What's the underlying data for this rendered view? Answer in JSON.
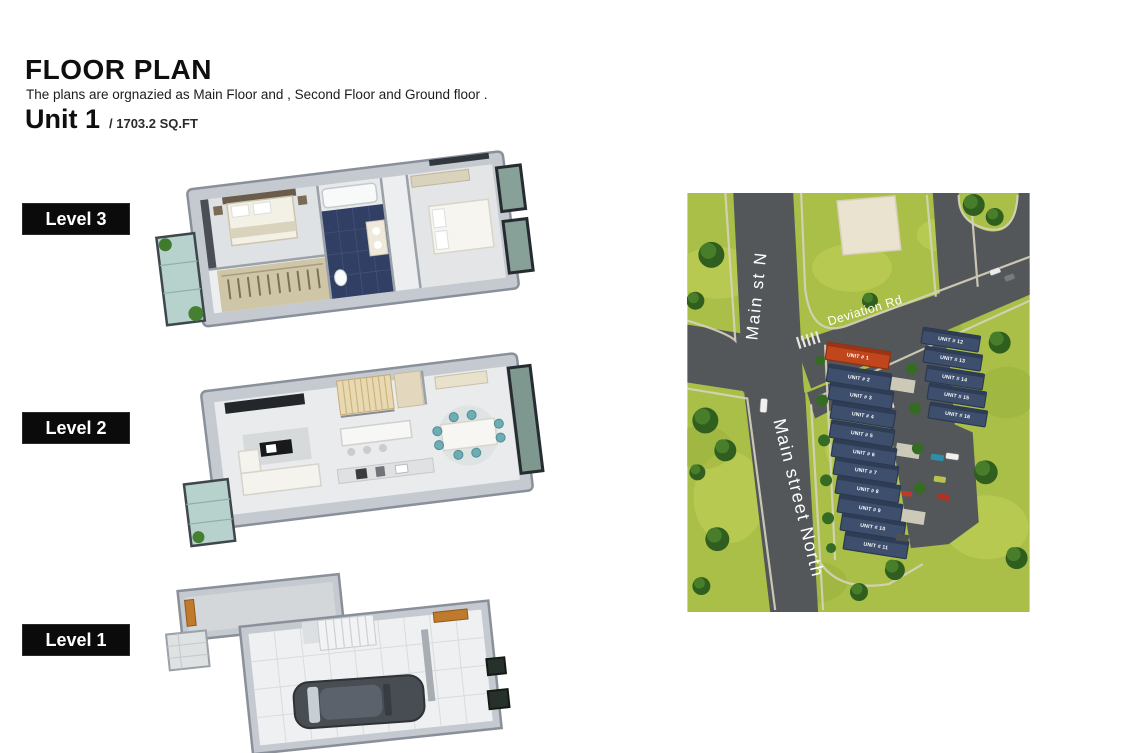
{
  "header": {
    "title": "FLOOR PLAN",
    "subtitle": "The plans are orgnazied as Main Floor and , Second Floor and Ground floor .",
    "unit_name": "Unit 1",
    "unit_area": "/ 1703.2 SQ.FT"
  },
  "levels": [
    {
      "label": "Level 3"
    },
    {
      "label": "Level 2"
    },
    {
      "label": "Level 1"
    }
  ],
  "site_map": {
    "road_labels": {
      "main_st_n": "Main st N",
      "deviation_rd": "Deviation Rd",
      "main_street_north": "Main street North"
    },
    "units": [
      "UNIT # 1",
      "UNIT # 2",
      "UNIT # 3",
      "UNIT # 4",
      "UNIT # 5",
      "UNIT # 6",
      "UNIT # 7",
      "UNIT # 8",
      "UNIT # 9",
      "UNIT # 10",
      "UNIT # 11",
      "UNIT # 12",
      "UNIT # 13",
      "UNIT # 14",
      "UNIT # 15",
      "UNIT # 16"
    ],
    "highlighted_unit": "UNIT # 1",
    "colors": {
      "highlight_unit": "#c0471d",
      "standard_unit": "#3e4f6d",
      "grass": "#a9bf48",
      "road": "#54575a"
    }
  }
}
